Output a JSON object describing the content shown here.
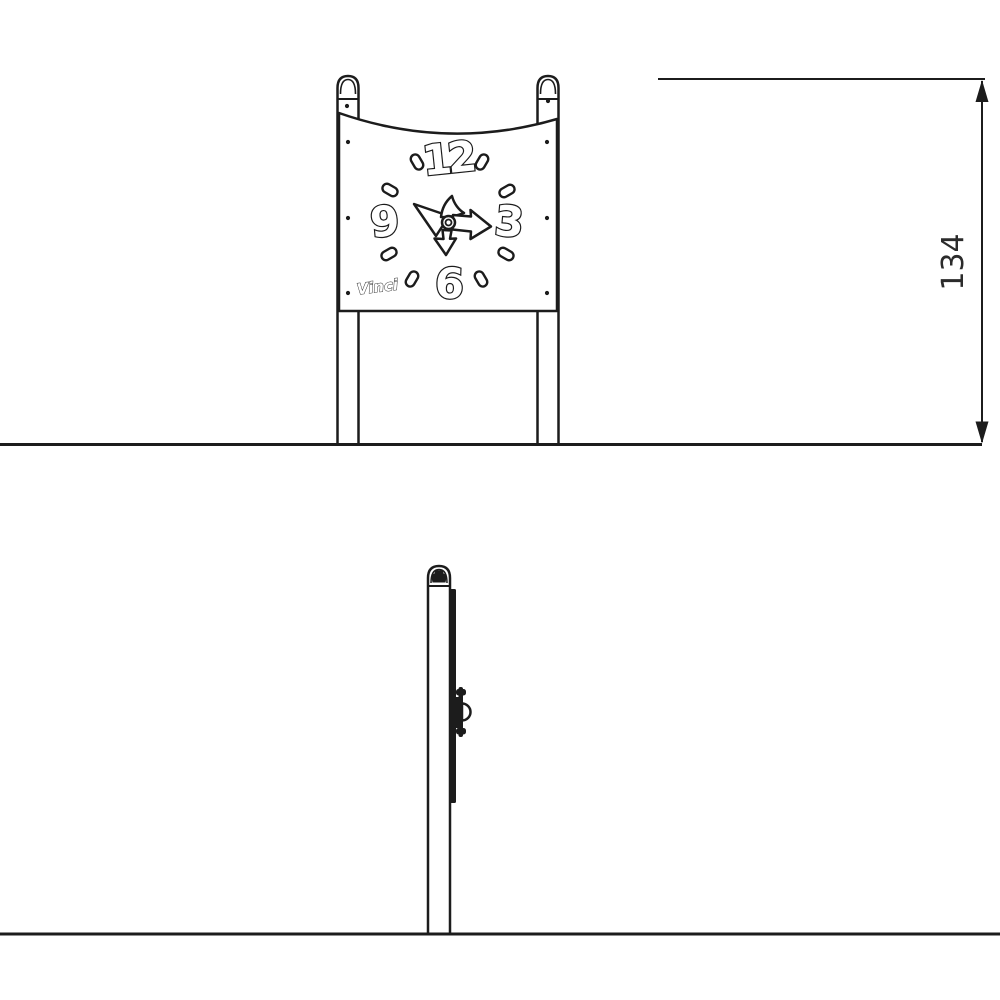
{
  "drawing": {
    "background": "#ffffff",
    "ink_color": "#1c1c1c",
    "front_view": {
      "clock": {
        "numerals": {
          "twelve": "12",
          "three": "3",
          "six": "6",
          "nine": "9"
        },
        "brand_logo": "Vinci"
      }
    },
    "dimension": {
      "height_label": "134"
    }
  }
}
